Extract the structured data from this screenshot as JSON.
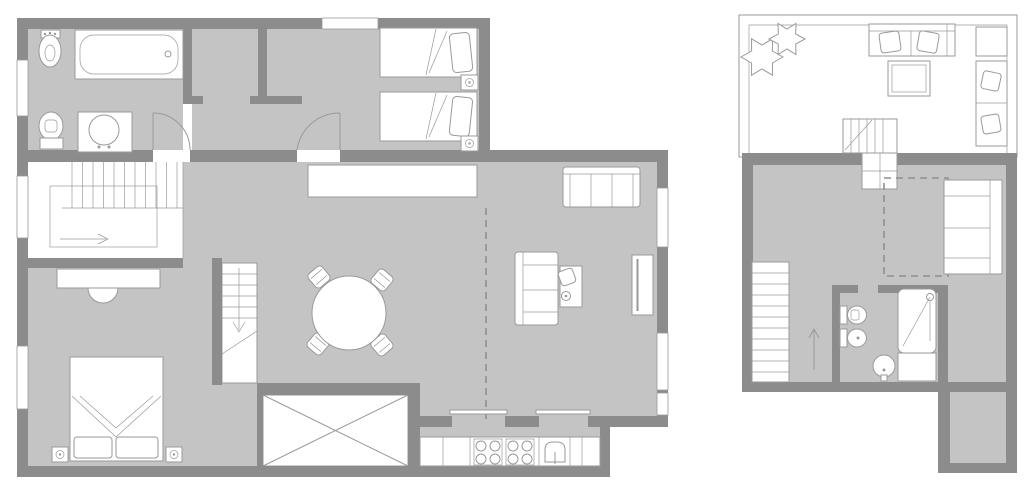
{
  "document": {
    "type": "apartment floor plan, two storeys, no text labels",
    "storeys": [
      "lower floor (left plan)",
      "upper floor with roof terrace (right plan)"
    ]
  },
  "colors": {
    "paper": "#ffffff",
    "wall": "#8c8c8c",
    "floor": "#c4c4c4",
    "line": "#9a9a9a",
    "dash": "#8f8f8f"
  },
  "lower_floor": {
    "rooms": [
      {
        "name": "bathroom",
        "position": "top-left",
        "fixtures": [
          "bidet",
          "bathtub",
          "toilet",
          "washbasin cabinet"
        ]
      },
      {
        "name": "entry hall / closet",
        "position": "top-center",
        "fixtures": []
      },
      {
        "name": "twin bedroom",
        "position": "top-right",
        "furniture": [
          "single bed x2",
          "nightstand with lamp x2"
        ]
      },
      {
        "name": "living-dining room",
        "position": "center-right",
        "furniture": [
          "sideboard",
          "three-seat sofa",
          "two-seat sofa",
          "desk with chair and lamp",
          "tv unit",
          "round dining table",
          "dining chair x4"
        ],
        "details": [
          "dashed zone-divider line",
          "sliding doors to kitchen"
        ]
      },
      {
        "name": "kitchen",
        "position": "bottom-center",
        "fixtures": [
          "counter",
          "cooktop with 8 burners",
          "sink with tap"
        ]
      },
      {
        "name": "master bedroom",
        "position": "bottom-left",
        "furniture": [
          "double bed with folded blanket",
          "nightstand with lamp x2",
          "dresser with chair"
        ]
      },
      {
        "name": "stair hall",
        "position": "left",
        "features": [
          "staircase treads",
          "walking line with arrow"
        ]
      },
      {
        "name": "inner staircase to upper floor",
        "position": "center",
        "features": [
          "treads",
          "down arrow",
          "break line"
        ]
      },
      {
        "name": "void / double-height space",
        "position": "bottom-center",
        "features": [
          "X cross"
        ]
      }
    ],
    "windows": [
      "left wall x3",
      "top wall x1",
      "right wall x3"
    ],
    "doors": [
      "swing door to bathroom",
      "swing door to twin bedroom",
      "kitchen sliding door x2"
    ]
  },
  "upper_floor": {
    "rooms": [
      {
        "name": "roof terrace",
        "position": "top",
        "furniture": [
          "plant x2",
          "outdoor sofa with cushions",
          "coffee table",
          "side table",
          "lounge seats with cushions x2",
          "terrace stairs"
        ]
      },
      {
        "name": "studio room",
        "position": "center",
        "furniture": [
          "daybed sofa",
          "dashed skylight outline",
          "arrival staircase",
          "up arrow"
        ]
      },
      {
        "name": "bathroom",
        "position": "bottom-center",
        "fixtures": [
          "toilet",
          "bidet",
          "shower cabin with head",
          "washbasin"
        ]
      },
      {
        "name": "side corridor / balcony strip",
        "position": "bottom-right",
        "features": []
      }
    ]
  }
}
